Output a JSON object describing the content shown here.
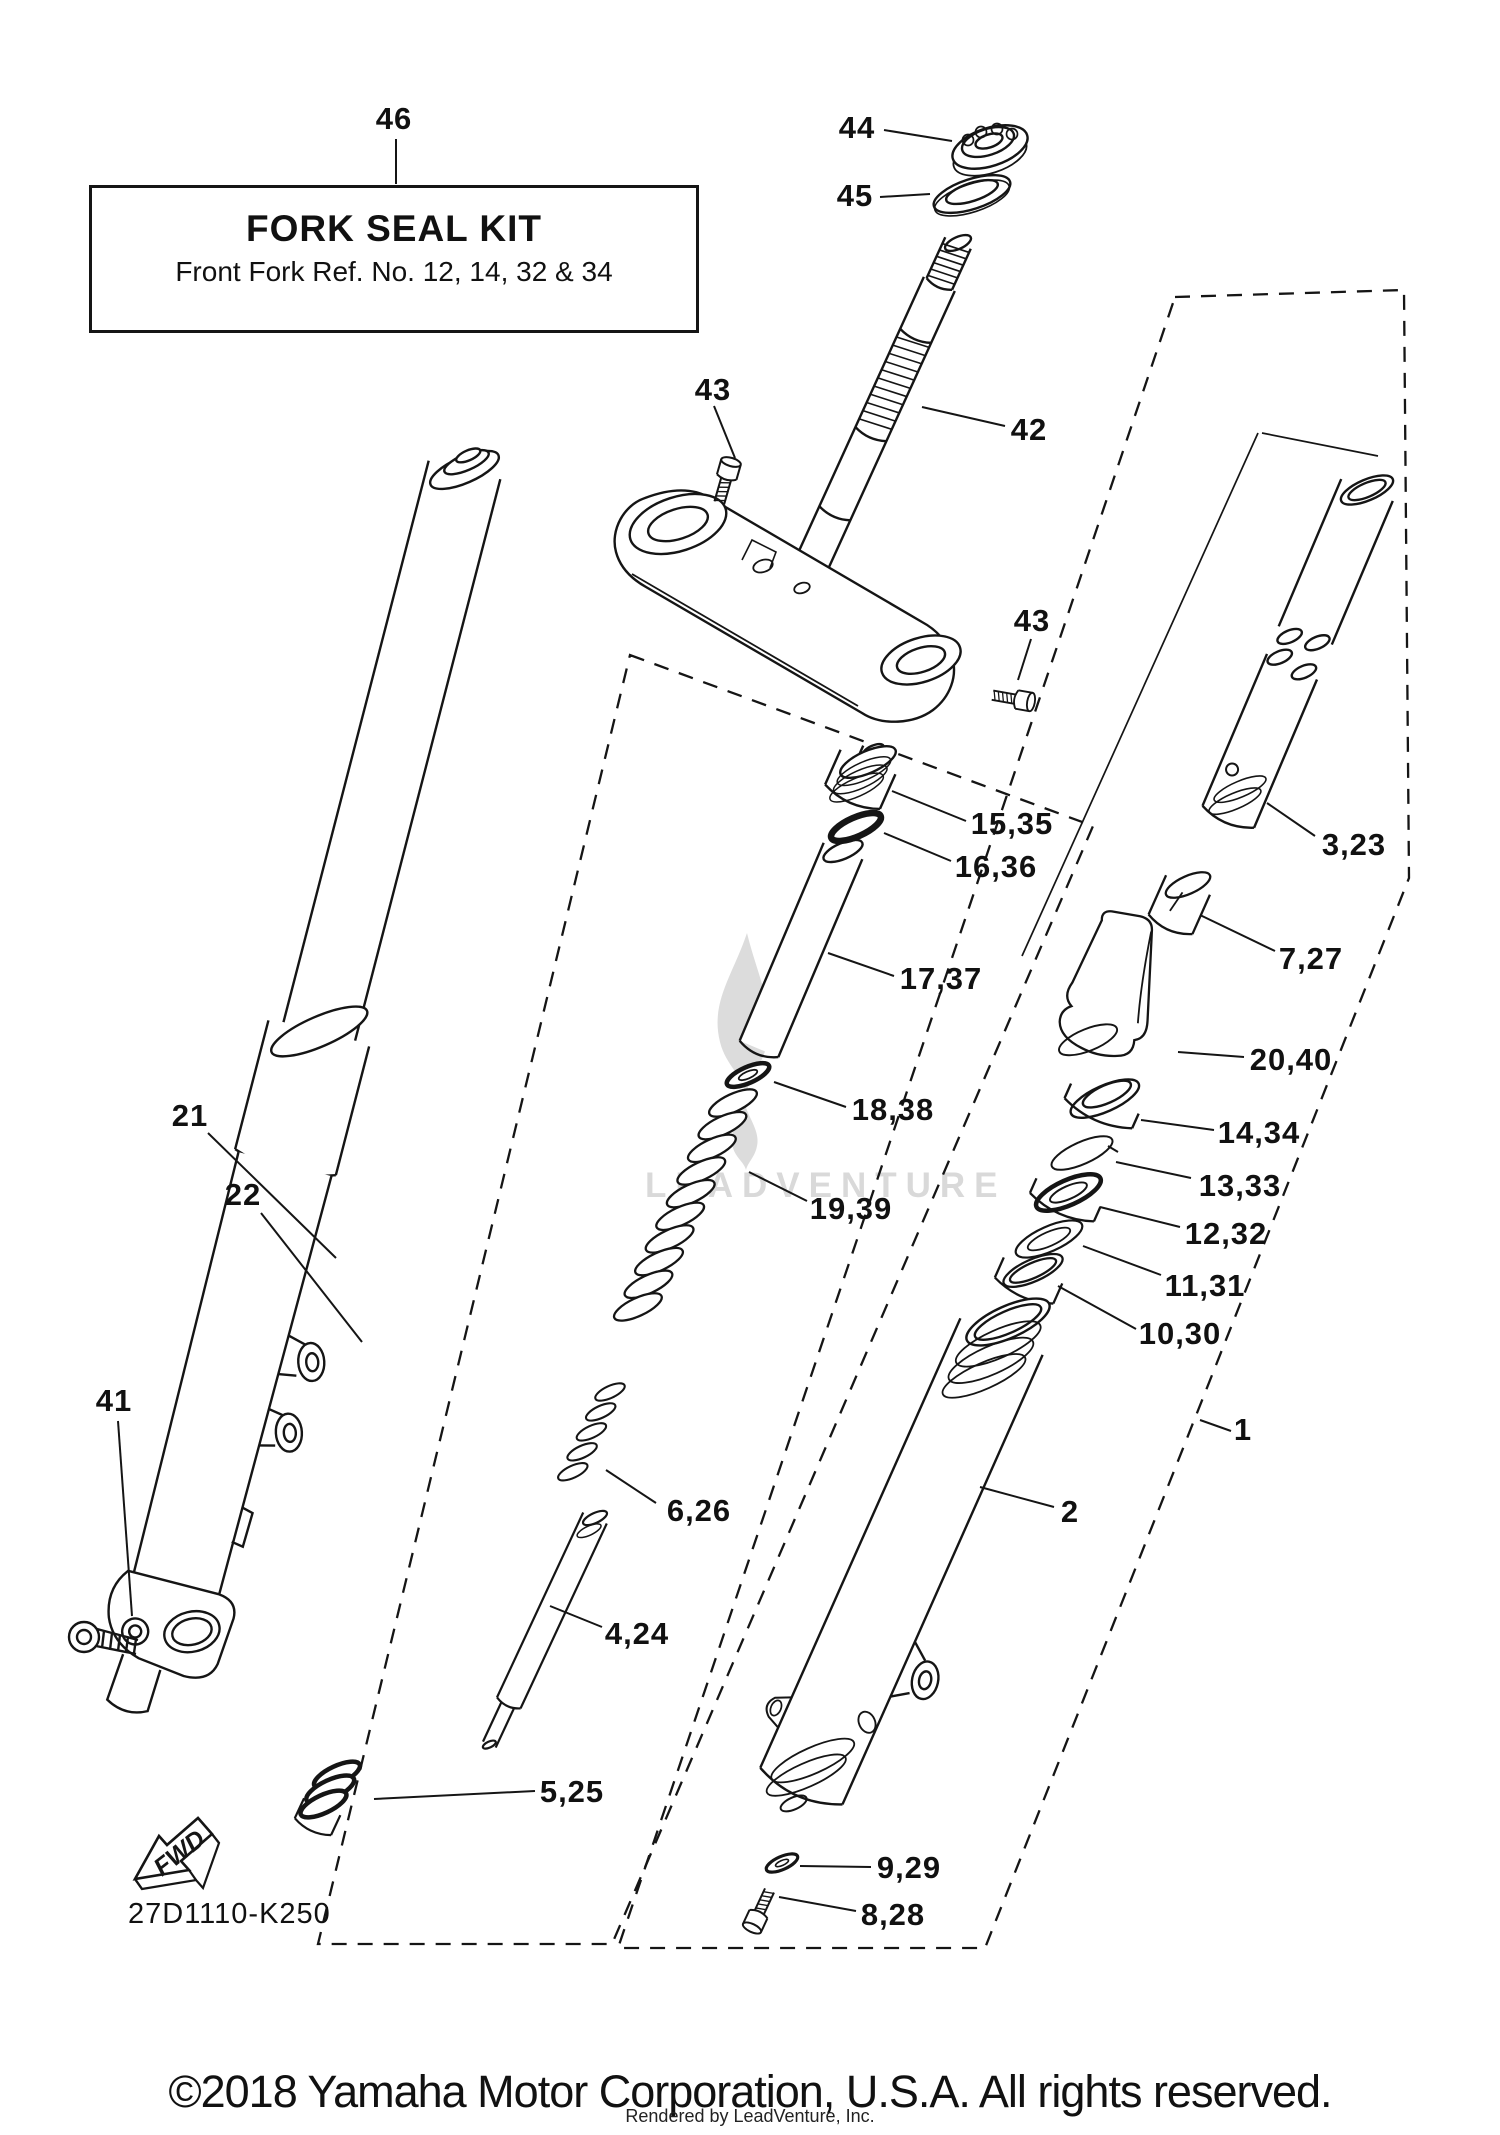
{
  "info_box": {
    "title": "FORK SEAL KIT",
    "subtitle": "Front Fork Ref. No. 12, 14, 32 & 34",
    "x": 89,
    "y": 185,
    "w": 604,
    "h": 142
  },
  "drawing_code": "27D1110-K250",
  "fwd_label": "FWD",
  "watermark": {
    "text": "LEADVENTURE"
  },
  "footer": {
    "copyright": "©2018 Yamaha Motor Corporation, U.S.A. All rights reserved.",
    "renderer": "Rendered by LeadVenture, Inc."
  },
  "colors": {
    "line": "#151515",
    "watermark": "#d9d9d9",
    "leader": "#151515"
  },
  "callouts": [
    {
      "label": "46",
      "x": 394,
      "y": 119,
      "lx1": 396,
      "ly1": 139,
      "lx2": 396,
      "ly2": 184
    },
    {
      "label": "44",
      "x": 857,
      "y": 128,
      "lx1": 884,
      "ly1": 130,
      "lx2": 952,
      "ly2": 141
    },
    {
      "label": "45",
      "x": 855,
      "y": 196,
      "lx1": 880,
      "ly1": 197,
      "lx2": 930,
      "ly2": 194
    },
    {
      "label": "42",
      "x": 1029,
      "y": 430,
      "lx1": 1005,
      "ly1": 426,
      "lx2": 922,
      "ly2": 407
    },
    {
      "label": "43",
      "x": 713,
      "y": 390,
      "lx1": 714,
      "ly1": 406,
      "lx2": 735,
      "ly2": 458
    },
    {
      "label": "43",
      "x": 1032,
      "y": 621,
      "lx1": 1031,
      "ly1": 639,
      "lx2": 1018,
      "ly2": 680
    },
    {
      "label": "15,35",
      "x": 1012,
      "y": 824,
      "lx1": 966,
      "ly1": 821,
      "lx2": 892,
      "ly2": 791
    },
    {
      "label": "16,36",
      "x": 996,
      "y": 867,
      "lx1": 951,
      "ly1": 861,
      "lx2": 884,
      "ly2": 833
    },
    {
      "label": "17,37",
      "x": 941,
      "y": 979,
      "lx1": 894,
      "ly1": 976,
      "lx2": 828,
      "ly2": 953
    },
    {
      "label": "18,38",
      "x": 893,
      "y": 1110,
      "lx1": 846,
      "ly1": 1107,
      "lx2": 774,
      "ly2": 1082
    },
    {
      "label": "19,39",
      "x": 851,
      "y": 1209,
      "lx1": 807,
      "ly1": 1201,
      "lx2": 749,
      "ly2": 1172
    },
    {
      "label": "3,23",
      "x": 1354,
      "y": 845,
      "lx1": 1315,
      "ly1": 836,
      "lx2": 1267,
      "ly2": 803
    },
    {
      "label": "7,27",
      "x": 1311,
      "y": 959,
      "lx1": 1275,
      "ly1": 951,
      "lx2": 1200,
      "ly2": 915
    },
    {
      "label": "20,40",
      "x": 1291,
      "y": 1060,
      "lx1": 1244,
      "ly1": 1057,
      "lx2": 1178,
      "ly2": 1052
    },
    {
      "label": "14,34",
      "x": 1259,
      "y": 1133,
      "lx1": 1214,
      "ly1": 1130,
      "lx2": 1141,
      "ly2": 1120
    },
    {
      "label": "13,33",
      "x": 1240,
      "y": 1186,
      "lx1": 1191,
      "ly1": 1178,
      "lx2": 1116,
      "ly2": 1162
    },
    {
      "label": "12,32",
      "x": 1226,
      "y": 1234,
      "lx1": 1180,
      "ly1": 1227,
      "lx2": 1100,
      "ly2": 1207
    },
    {
      "label": "11,31",
      "x": 1205,
      "y": 1286,
      "lx1": 1161,
      "ly1": 1275,
      "lx2": 1083,
      "ly2": 1246
    },
    {
      "label": "10,30",
      "x": 1180,
      "y": 1334,
      "lx1": 1136,
      "ly1": 1329,
      "lx2": 1058,
      "ly2": 1286
    },
    {
      "label": "1",
      "x": 1243,
      "y": 1430,
      "lx1": 1231,
      "ly1": 1431,
      "lx2": 1200,
      "ly2": 1420
    },
    {
      "label": "2",
      "x": 1070,
      "y": 1512,
      "lx1": 1054,
      "ly1": 1507,
      "lx2": 980,
      "ly2": 1487
    },
    {
      "label": "9,29",
      "x": 909,
      "y": 1868,
      "lx1": 871,
      "ly1": 1867,
      "lx2": 800,
      "ly2": 1866
    },
    {
      "label": "8,28",
      "x": 893,
      "y": 1915,
      "lx1": 856,
      "ly1": 1911,
      "lx2": 779,
      "ly2": 1897
    },
    {
      "label": "6,26",
      "x": 699,
      "y": 1511,
      "lx1": 656,
      "ly1": 1503,
      "lx2": 606,
      "ly2": 1470
    },
    {
      "label": "4,24",
      "x": 637,
      "y": 1634,
      "lx1": 602,
      "ly1": 1627,
      "lx2": 550,
      "ly2": 1606
    },
    {
      "label": "5,25",
      "x": 572,
      "y": 1792,
      "lx1": 535,
      "ly1": 1791,
      "lx2": 374,
      "ly2": 1799
    },
    {
      "label": "21",
      "x": 190,
      "y": 1116,
      "lx1": 208,
      "ly1": 1133,
      "lx2": 336,
      "ly2": 1258
    },
    {
      "label": "22",
      "x": 243,
      "y": 1195,
      "lx1": 261,
      "ly1": 1213,
      "lx2": 362,
      "ly2": 1342
    },
    {
      "label": "41",
      "x": 114,
      "y": 1401,
      "lx1": 118,
      "ly1": 1421,
      "lx2": 132,
      "ly2": 1616
    }
  ]
}
